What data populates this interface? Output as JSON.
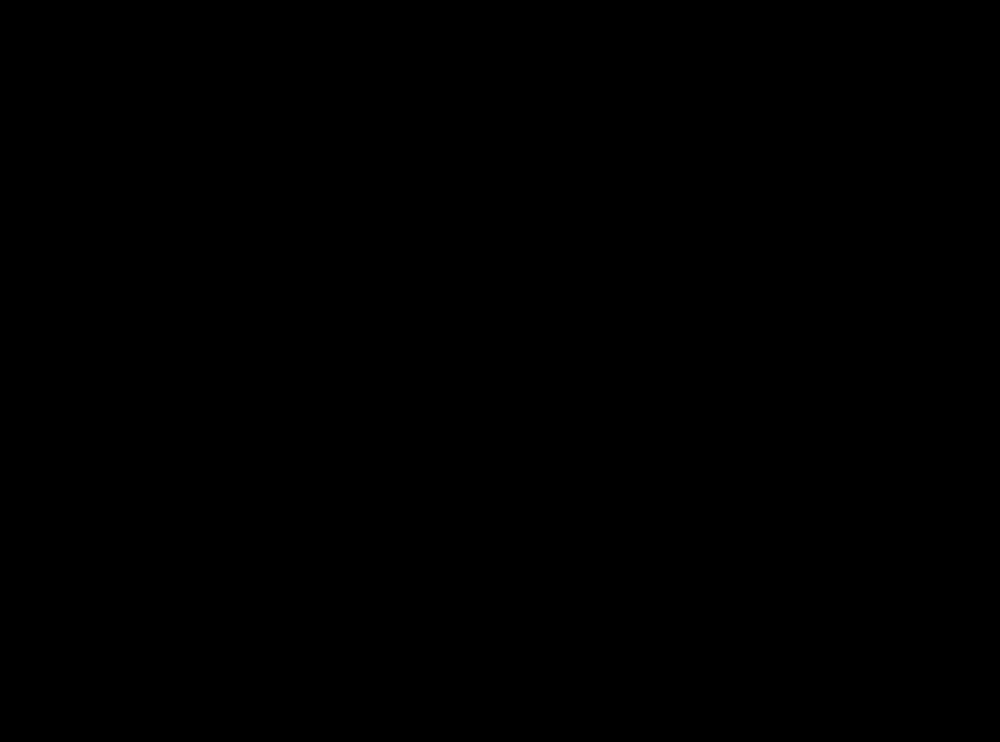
{
  "canvas": {
    "w": 1000,
    "h": 742,
    "bg": "#000000"
  },
  "palette": {
    "floor": "#ffffff",
    "evac_red": "#fa0000",
    "desk_gray": "#bfbfbf",
    "mid_gray": "#9b9b9b",
    "outline": "#1a1a1a",
    "door_line": "#2b2b2b"
  },
  "rooms": [
    {
      "id": "room-office-top-left",
      "x": 119,
      "y": 23,
      "w": 253,
      "h": 253
    },
    {
      "id": "room-meeting",
      "x": 385,
      "y": 23,
      "w": 223,
      "h": 253
    },
    {
      "id": "room-office-top-right",
      "x": 628,
      "y": 23,
      "w": 253,
      "h": 253
    },
    {
      "id": "room-bathroom-left",
      "x": 119,
      "y": 283,
      "w": 151,
      "h": 102
    },
    {
      "id": "room-bathroom-right",
      "x": 730,
      "y": 283,
      "w": 151,
      "h": 102
    },
    {
      "id": "room-office-bottom-left",
      "x": 119,
      "y": 390,
      "w": 253,
      "h": 251
    },
    {
      "id": "room-office-bottom-right",
      "x": 628,
      "y": 390,
      "w": 253,
      "h": 251
    },
    {
      "id": "exit-opening",
      "x": 436,
      "y": 637,
      "w": 124,
      "h": 16
    }
  ],
  "doors": [
    {
      "id": "door-office-top-left",
      "gap": [
        303,
        275,
        58,
        13
      ],
      "arc": "M304,283 A57,57 0 0 1 361,226",
      "leaf": [
        361,
        226,
        9,
        57
      ]
    },
    {
      "id": "door-meeting-left",
      "gap": [
        392,
        275,
        57,
        13
      ],
      "arc": "M392,226 A57,57 0 0 1 449,283",
      "leaf": [
        385,
        226,
        7,
        57
      ]
    },
    {
      "id": "door-meeting-right",
      "gap": [
        551,
        275,
        57,
        13
      ],
      "arc": "M551,283 A57,57 0 0 1 608,226",
      "leaf": [
        601,
        226,
        7,
        57
      ]
    },
    {
      "id": "door-office-top-right",
      "gap": [
        638,
        275,
        58,
        13
      ],
      "arc": "M638,226 A57,57 0 0 1 696,283",
      "leaf": [
        628,
        226,
        10,
        57
      ]
    },
    {
      "id": "door-office-bottom-left",
      "gap": [
        303,
        378,
        59,
        14
      ],
      "arc": "M304,380 A58,58 0 0 0 362,438",
      "leaf": null
    },
    {
      "id": "door-office-bottom-right",
      "gap": [
        638,
        378,
        59,
        14
      ],
      "arc": "M696,380 A58,58 0 0 1 638,438",
      "leaf": null
    },
    {
      "id": "door-bathroom-left",
      "gap": [
        270,
        285,
        13,
        59
      ],
      "arc": "M225,285 A58,58 0 0 0 283,343",
      "leaf": [
        270,
        285,
        13,
        59
      ]
    },
    {
      "id": "door-bathroom-right",
      "gap": [
        717,
        321,
        13,
        58
      ],
      "arc": "M775,321 A58,58 0 0 1 717,379",
      "leaf": [
        717,
        321,
        13,
        58
      ]
    }
  ],
  "evacuation": {
    "solid_paths": [
      {
        "id": "evac-path-left",
        "d": "M333,325 H409 V597"
      },
      {
        "id": "evac-path-right",
        "d": "M663,332 H590 V597"
      },
      {
        "id": "evac-path-bottom",
        "d": "M405,597 H593"
      },
      {
        "id": "evac-path-exit-stem",
        "d": "M498,597 V637"
      }
    ],
    "solid_width": 8,
    "exit_head": [
      [
        498,
        657
      ],
      [
        487,
        636
      ],
      [
        509,
        636
      ]
    ],
    "dash": {
      "width": 7,
      "pattern": "9 6",
      "head_len": 15,
      "head_w": 15
    },
    "dashed_arrows": [
      {
        "id": "evac-arrow-office-top-left",
        "tail": [
          333,
          253
        ],
        "tip": [
          333,
          317
        ]
      },
      {
        "id": "evac-arrow-meeting-left",
        "tail": [
          406,
          253
        ],
        "tip": [
          406,
          317
        ]
      },
      {
        "id": "evac-arrow-meeting-right",
        "tail": [
          590,
          253
        ],
        "tip": [
          590,
          317
        ]
      },
      {
        "id": "evac-arrow-office-top-right",
        "tail": [
          666,
          253
        ],
        "tip": [
          666,
          317
        ]
      },
      {
        "id": "evac-arrow-bathroom-left",
        "tail": [
          237,
          325
        ],
        "tip": [
          326,
          325
        ]
      },
      {
        "id": "evac-arrow-bathroom-right",
        "tail": [
          768,
          332
        ],
        "tip": [
          668,
          332
        ]
      },
      {
        "id": "evac-arrow-office-bottom-left",
        "tail": [
          333,
          422
        ],
        "tip": [
          333,
          362
        ]
      },
      {
        "id": "evac-arrow-office-bottom-right",
        "tail": [
          666,
          422
        ],
        "tip": [
          666,
          362
        ]
      }
    ]
  },
  "defs": {
    "office": [
      {
        "t": "path",
        "n": "corner-desk",
        "d": "M0,0 H198 V54 H88 Q58,60 55,112 V198 H0 Z",
        "f": "#bfbfbf",
        "s": "#1a1a1a",
        "sw": 1.5
      },
      {
        "t": "circle",
        "n": "floor-spot",
        "cx": 44,
        "cy": 7,
        "r": 14,
        "f": "#ffffff",
        "s": "#8a8a8a",
        "sw": 1.2
      },
      {
        "t": "circle",
        "n": "floor-spot",
        "cx": 0,
        "cy": 55,
        "r": 12,
        "f": "#ffffff",
        "s": "#8a8a8a",
        "sw": 1.2
      },
      {
        "t": "rect",
        "n": "sofa-frame",
        "x": 108,
        "y": 0,
        "w": 86,
        "h": 33,
        "f": "#b3b3b3",
        "s": "#1a1a1a",
        "sw": 1.5
      },
      {
        "t": "rect",
        "n": "sofa-seat",
        "x": 115,
        "y": 5,
        "w": 72,
        "h": 23,
        "f": "#9b9b9b",
        "s": "#333333",
        "sw": 1
      },
      {
        "t": "rect",
        "n": "sofa-notch",
        "x": 143,
        "y": -1,
        "w": 16,
        "h": 5,
        "f": "#ffffff"
      },
      {
        "t": "rect",
        "n": "bookcase",
        "x": 0,
        "y": 119,
        "w": 31,
        "h": 71,
        "f": "#acacac",
        "s": "#1a1a1a",
        "sw": 1.5
      },
      {
        "t": "line",
        "n": "bookcase-line",
        "x1": 5,
        "y1": 121,
        "x2": 5,
        "y2": 188,
        "s": "#666666",
        "sw": 1
      },
      {
        "t": "line",
        "n": "bookcase-line",
        "x1": 26,
        "y1": 121,
        "x2": 26,
        "y2": 188,
        "s": "#666666",
        "sw": 1
      },
      {
        "t": "circle",
        "n": "bookcase-knob",
        "cx": 31,
        "cy": 154,
        "r": 3,
        "f": "#ffffff",
        "s": "#444444",
        "sw": 1
      },
      {
        "t": "ellipse",
        "n": "monitor-base",
        "cx": 45,
        "cy": 42,
        "rx": 11,
        "ry": 10,
        "f": "#919191",
        "s": "#333333",
        "sw": 1
      },
      {
        "t": "g",
        "n": "monitor",
        "transform": "translate(49,44) rotate(-45)",
        "children": [
          {
            "t": "rect",
            "x": -21,
            "y": -3,
            "w": 42,
            "h": 6,
            "rx": 1,
            "f": "#111111"
          }
        ]
      },
      {
        "t": "g",
        "n": "keyboard",
        "transform": "translate(67,60) rotate(-45)",
        "children": [
          {
            "t": "rect",
            "x": -15,
            "y": -6,
            "w": 30,
            "h": 12,
            "f": "#d4d4d4",
            "s": "#222222",
            "sw": 1
          },
          {
            "t": "rect",
            "x": -12,
            "y": -4,
            "w": 20,
            "h": 4,
            "f": "#777777"
          },
          {
            "t": "rect",
            "x": -12,
            "y": 1,
            "w": 24,
            "h": 3,
            "f": "#777777"
          }
        ]
      },
      {
        "t": "g",
        "n": "mouse",
        "transform": "translate(46,79) rotate(-45)",
        "children": [
          {
            "t": "rect",
            "x": -3,
            "y": -4,
            "w": 6,
            "h": 8,
            "rx": 2.5,
            "f": "#e4e4e4",
            "s": "#222222",
            "sw": 1
          }
        ]
      },
      {
        "t": "g",
        "n": "office-chair",
        "transform": "translate(83,84) rotate(-45)",
        "children": [
          {
            "t": "rect",
            "x": -22,
            "y": -10,
            "w": 6,
            "h": 20,
            "rx": 3,
            "f": "#3f3f3f"
          },
          {
            "t": "rect",
            "x": 16,
            "y": -10,
            "w": 6,
            "h": 20,
            "rx": 3,
            "f": "#3f3f3f"
          },
          {
            "t": "path",
            "d": "M-17,3 A20,20 0 0,0 17,3 L13,12 A13,13 0 0,1 -13,12 Z",
            "f": "#c6c6c6",
            "s": "#111111",
            "sw": 1.3
          },
          {
            "t": "ellipse",
            "cx": 0,
            "cy": -2,
            "rx": 14,
            "ry": 13,
            "f": "#c6c6c6",
            "s": "#111111",
            "sw": 1.3
          }
        ]
      }
    ],
    "bathroom": [
      {
        "t": "rect",
        "n": "sink-counter",
        "x": 122,
        "y": 286,
        "w": 34,
        "h": 47,
        "f": "#6e6e6e",
        "s": "#1a1a1a",
        "sw": 1.5
      },
      {
        "t": "ellipse",
        "n": "sink-basin",
        "cx": 141,
        "cy": 309,
        "rx": 12,
        "ry": 19,
        "f": "#ffffff",
        "s": "#111111",
        "sw": 1.5
      },
      {
        "t": "ellipse",
        "cx": 141,
        "cy": 309,
        "rx": 9,
        "ry": 15,
        "f": "none",
        "s": "#999999",
        "sw": 1
      },
      {
        "t": "circle",
        "n": "sink-drain",
        "cx": 145,
        "cy": 310,
        "r": 2,
        "f": "#111111"
      },
      {
        "t": "rect",
        "n": "faucet",
        "x": 121,
        "y": 303,
        "w": 9,
        "h": 13,
        "f": "#b9b9b9",
        "s": "#333333",
        "sw": 1
      },
      {
        "t": "circle",
        "cx": 124,
        "cy": 300,
        "r": 3,
        "f": "#cfcfcf",
        "s": "#333333",
        "sw": 1
      },
      {
        "t": "circle",
        "cx": 124,
        "cy": 319,
        "r": 3,
        "f": "#cfcfcf",
        "s": "#333333",
        "sw": 1
      },
      {
        "t": "rect",
        "n": "toilet-tank",
        "x": 121,
        "y": 349,
        "w": 13,
        "h": 31,
        "f": "#dcdcdc",
        "s": "#111111",
        "sw": 1.3
      },
      {
        "t": "rect",
        "x": 123.5,
        "y": 352,
        "w": 8,
        "h": 25,
        "f": "none",
        "s": "#777777",
        "sw": 1
      },
      {
        "t": "circle",
        "cx": 127,
        "cy": 357,
        "r": 2.5,
        "f": "#8f8f8f",
        "s": "#333333",
        "sw": 0.8
      },
      {
        "t": "ellipse",
        "n": "toilet-bowl",
        "cx": 156,
        "cy": 364,
        "rx": 22,
        "ry": 17.5,
        "f": "#ffffff",
        "s": "#111111",
        "sw": 1.5
      },
      {
        "t": "ellipse",
        "cx": 158,
        "cy": 364,
        "rx": 15,
        "ry": 12,
        "f": "none",
        "s": "#444444",
        "sw": 1.2
      },
      {
        "t": "ellipse",
        "n": "toilet-drain",
        "cx": 152,
        "cy": 364,
        "rx": 6,
        "ry": 7.5,
        "f": "#000000"
      }
    ],
    "meeting": [
      {
        "t": "g",
        "n": "meeting-chair",
        "transform": "translate(459,50)",
        "children": [
          {
            "t": "rect",
            "x": 0,
            "y": 0,
            "w": 46,
            "h": 11,
            "rx": 2,
            "f": "#8f8f8f",
            "s": "#111111",
            "sw": 1.3
          },
          {
            "t": "rect",
            "x": 3,
            "y": 5,
            "w": 40,
            "h": 24,
            "rx": 4,
            "f": "#8f8f8f",
            "s": "#111111",
            "sw": 1.3
          }
        ]
      },
      {
        "t": "g",
        "n": "meeting-chair",
        "transform": "translate(513,50)",
        "children": [
          {
            "t": "rect",
            "x": 0,
            "y": 0,
            "w": 46,
            "h": 11,
            "rx": 2,
            "f": "#8f8f8f",
            "s": "#111111",
            "sw": 1.3
          },
          {
            "t": "rect",
            "x": 3,
            "y": 5,
            "w": 40,
            "h": 24,
            "rx": 4,
            "f": "#8f8f8f",
            "s": "#111111",
            "sw": 1.3
          }
        ]
      },
      {
        "t": "g",
        "n": "meeting-chair",
        "transform": "translate(459,241) scale(1,-1)",
        "children": [
          {
            "t": "rect",
            "x": 0,
            "y": 0,
            "w": 46,
            "h": 11,
            "rx": 2,
            "f": "#8f8f8f",
            "s": "#111111",
            "sw": 1.3
          },
          {
            "t": "rect",
            "x": 3,
            "y": 5,
            "w": 40,
            "h": 24,
            "rx": 4,
            "f": "#8f8f8f",
            "s": "#111111",
            "sw": 1.3
          }
        ]
      },
      {
        "t": "g",
        "n": "meeting-chair",
        "transform": "translate(513,241) scale(1,-1)",
        "children": [
          {
            "t": "rect",
            "x": 0,
            "y": 0,
            "w": 46,
            "h": 11,
            "rx": 2,
            "f": "#8f8f8f",
            "s": "#111111",
            "sw": 1.3
          },
          {
            "t": "rect",
            "x": 3,
            "y": 5,
            "w": 40,
            "h": 24,
            "rx": 4,
            "f": "#8f8f8f",
            "s": "#111111",
            "sw": 1.3
          }
        ]
      },
      {
        "t": "g",
        "n": "meeting-chair",
        "transform": "translate(415,96)",
        "children": [
          {
            "t": "rect",
            "x": 0,
            "y": 0,
            "w": 11,
            "h": 46,
            "rx": 2,
            "f": "#8f8f8f",
            "s": "#111111",
            "sw": 1.3
          },
          {
            "t": "rect",
            "x": 5,
            "y": 3,
            "w": 24,
            "h": 40,
            "rx": 4,
            "f": "#8f8f8f",
            "s": "#111111",
            "sw": 1.3
          }
        ]
      },
      {
        "t": "g",
        "n": "meeting-chair",
        "transform": "translate(415,146)",
        "children": [
          {
            "t": "rect",
            "x": 0,
            "y": 0,
            "w": 11,
            "h": 46,
            "rx": 2,
            "f": "#8f8f8f",
            "s": "#111111",
            "sw": 1.3
          },
          {
            "t": "rect",
            "x": 5,
            "y": 3,
            "w": 24,
            "h": 40,
            "rx": 4,
            "f": "#8f8f8f",
            "s": "#111111",
            "sw": 1.3
          }
        ]
      },
      {
        "t": "g",
        "n": "meeting-chair",
        "transform": "translate(606,96) scale(-1,1)",
        "children": [
          {
            "t": "rect",
            "x": 0,
            "y": 0,
            "w": 11,
            "h": 46,
            "rx": 2,
            "f": "#8f8f8f",
            "s": "#111111",
            "sw": 1.3
          },
          {
            "t": "rect",
            "x": 5,
            "y": 3,
            "w": 24,
            "h": 40,
            "rx": 4,
            "f": "#8f8f8f",
            "s": "#111111",
            "sw": 1.3
          }
        ]
      },
      {
        "t": "g",
        "n": "meeting-chair",
        "transform": "translate(606,146) scale(-1,1)",
        "children": [
          {
            "t": "rect",
            "x": 0,
            "y": 0,
            "w": 11,
            "h": 46,
            "rx": 2,
            "f": "#8f8f8f",
            "s": "#111111",
            "sw": 1.3
          },
          {
            "t": "rect",
            "x": 5,
            "y": 3,
            "w": 24,
            "h": 40,
            "rx": 4,
            "f": "#8f8f8f",
            "s": "#111111",
            "sw": 1.3
          }
        ]
      },
      {
        "t": "rect",
        "n": "meeting-table",
        "x": 442,
        "y": 78,
        "w": 136,
        "h": 132,
        "rx": 16,
        "f": "#c2c2c2",
        "s": "#1a1a1a",
        "sw": 2
      }
    ],
    "hall_sofa": [
      {
        "t": "rect",
        "n": "sofa-rail",
        "x": 461,
        "y": 446,
        "w": 38,
        "h": 4,
        "f": "#8f8f8f",
        "s": "#222222",
        "sw": 1
      },
      {
        "t": "rect",
        "n": "sofa-rail",
        "x": 503,
        "y": 446,
        "w": 36,
        "h": 4,
        "f": "#8f8f8f",
        "s": "#222222",
        "sw": 1
      },
      {
        "t": "circle",
        "n": "sofa-bump",
        "cx": 444,
        "cy": 450,
        "r": 6,
        "f": "#a8a8a8",
        "s": "#333333",
        "sw": 1.3
      },
      {
        "t": "circle",
        "n": "sofa-bump",
        "cx": 555,
        "cy": 450,
        "r": 6,
        "f": "#a8a8a8",
        "s": "#333333",
        "sw": 1.3
      },
      {
        "t": "rect",
        "n": "sofa-body",
        "x": 425,
        "y": 450,
        "w": 150,
        "h": 42,
        "f": "#b8b8b8",
        "s": "#444444",
        "sw": 1.5
      },
      {
        "t": "rect",
        "n": "sofa-cushion",
        "x": 429,
        "y": 453,
        "w": 31,
        "h": 36,
        "f": "none",
        "s": "#111111",
        "sw": 1.3,
        "da": "2.5 2.5"
      },
      {
        "t": "rect",
        "n": "sofa-cushion",
        "x": 539,
        "y": 453,
        "w": 33,
        "h": 36,
        "f": "none",
        "s": "#111111",
        "sw": 1.3,
        "da": "2.5 2.5"
      }
    ]
  },
  "instances": [
    {
      "def": "office",
      "name": "furniture-office-top-left",
      "transform": "translate(119,23)"
    },
    {
      "def": "office",
      "name": "furniture-office-top-right",
      "transform": "translate(881,23) scale(-1,1)"
    },
    {
      "def": "office",
      "name": "furniture-office-bottom-left",
      "transform": "translate(119,641) scale(1,-1)"
    },
    {
      "def": "office",
      "name": "furniture-office-bottom-right",
      "transform": "translate(881,641) scale(-1,-1)"
    },
    {
      "def": "bathroom",
      "name": "fixtures-bathroom-left",
      "transform": ""
    },
    {
      "def": "bathroom",
      "name": "fixtures-bathroom-right",
      "transform": "rotate(180 500 334)"
    },
    {
      "def": "meeting",
      "name": "furniture-meeting-room",
      "transform": ""
    },
    {
      "def": "hall_sofa",
      "name": "hallway-sofa",
      "transform": ""
    }
  ]
}
